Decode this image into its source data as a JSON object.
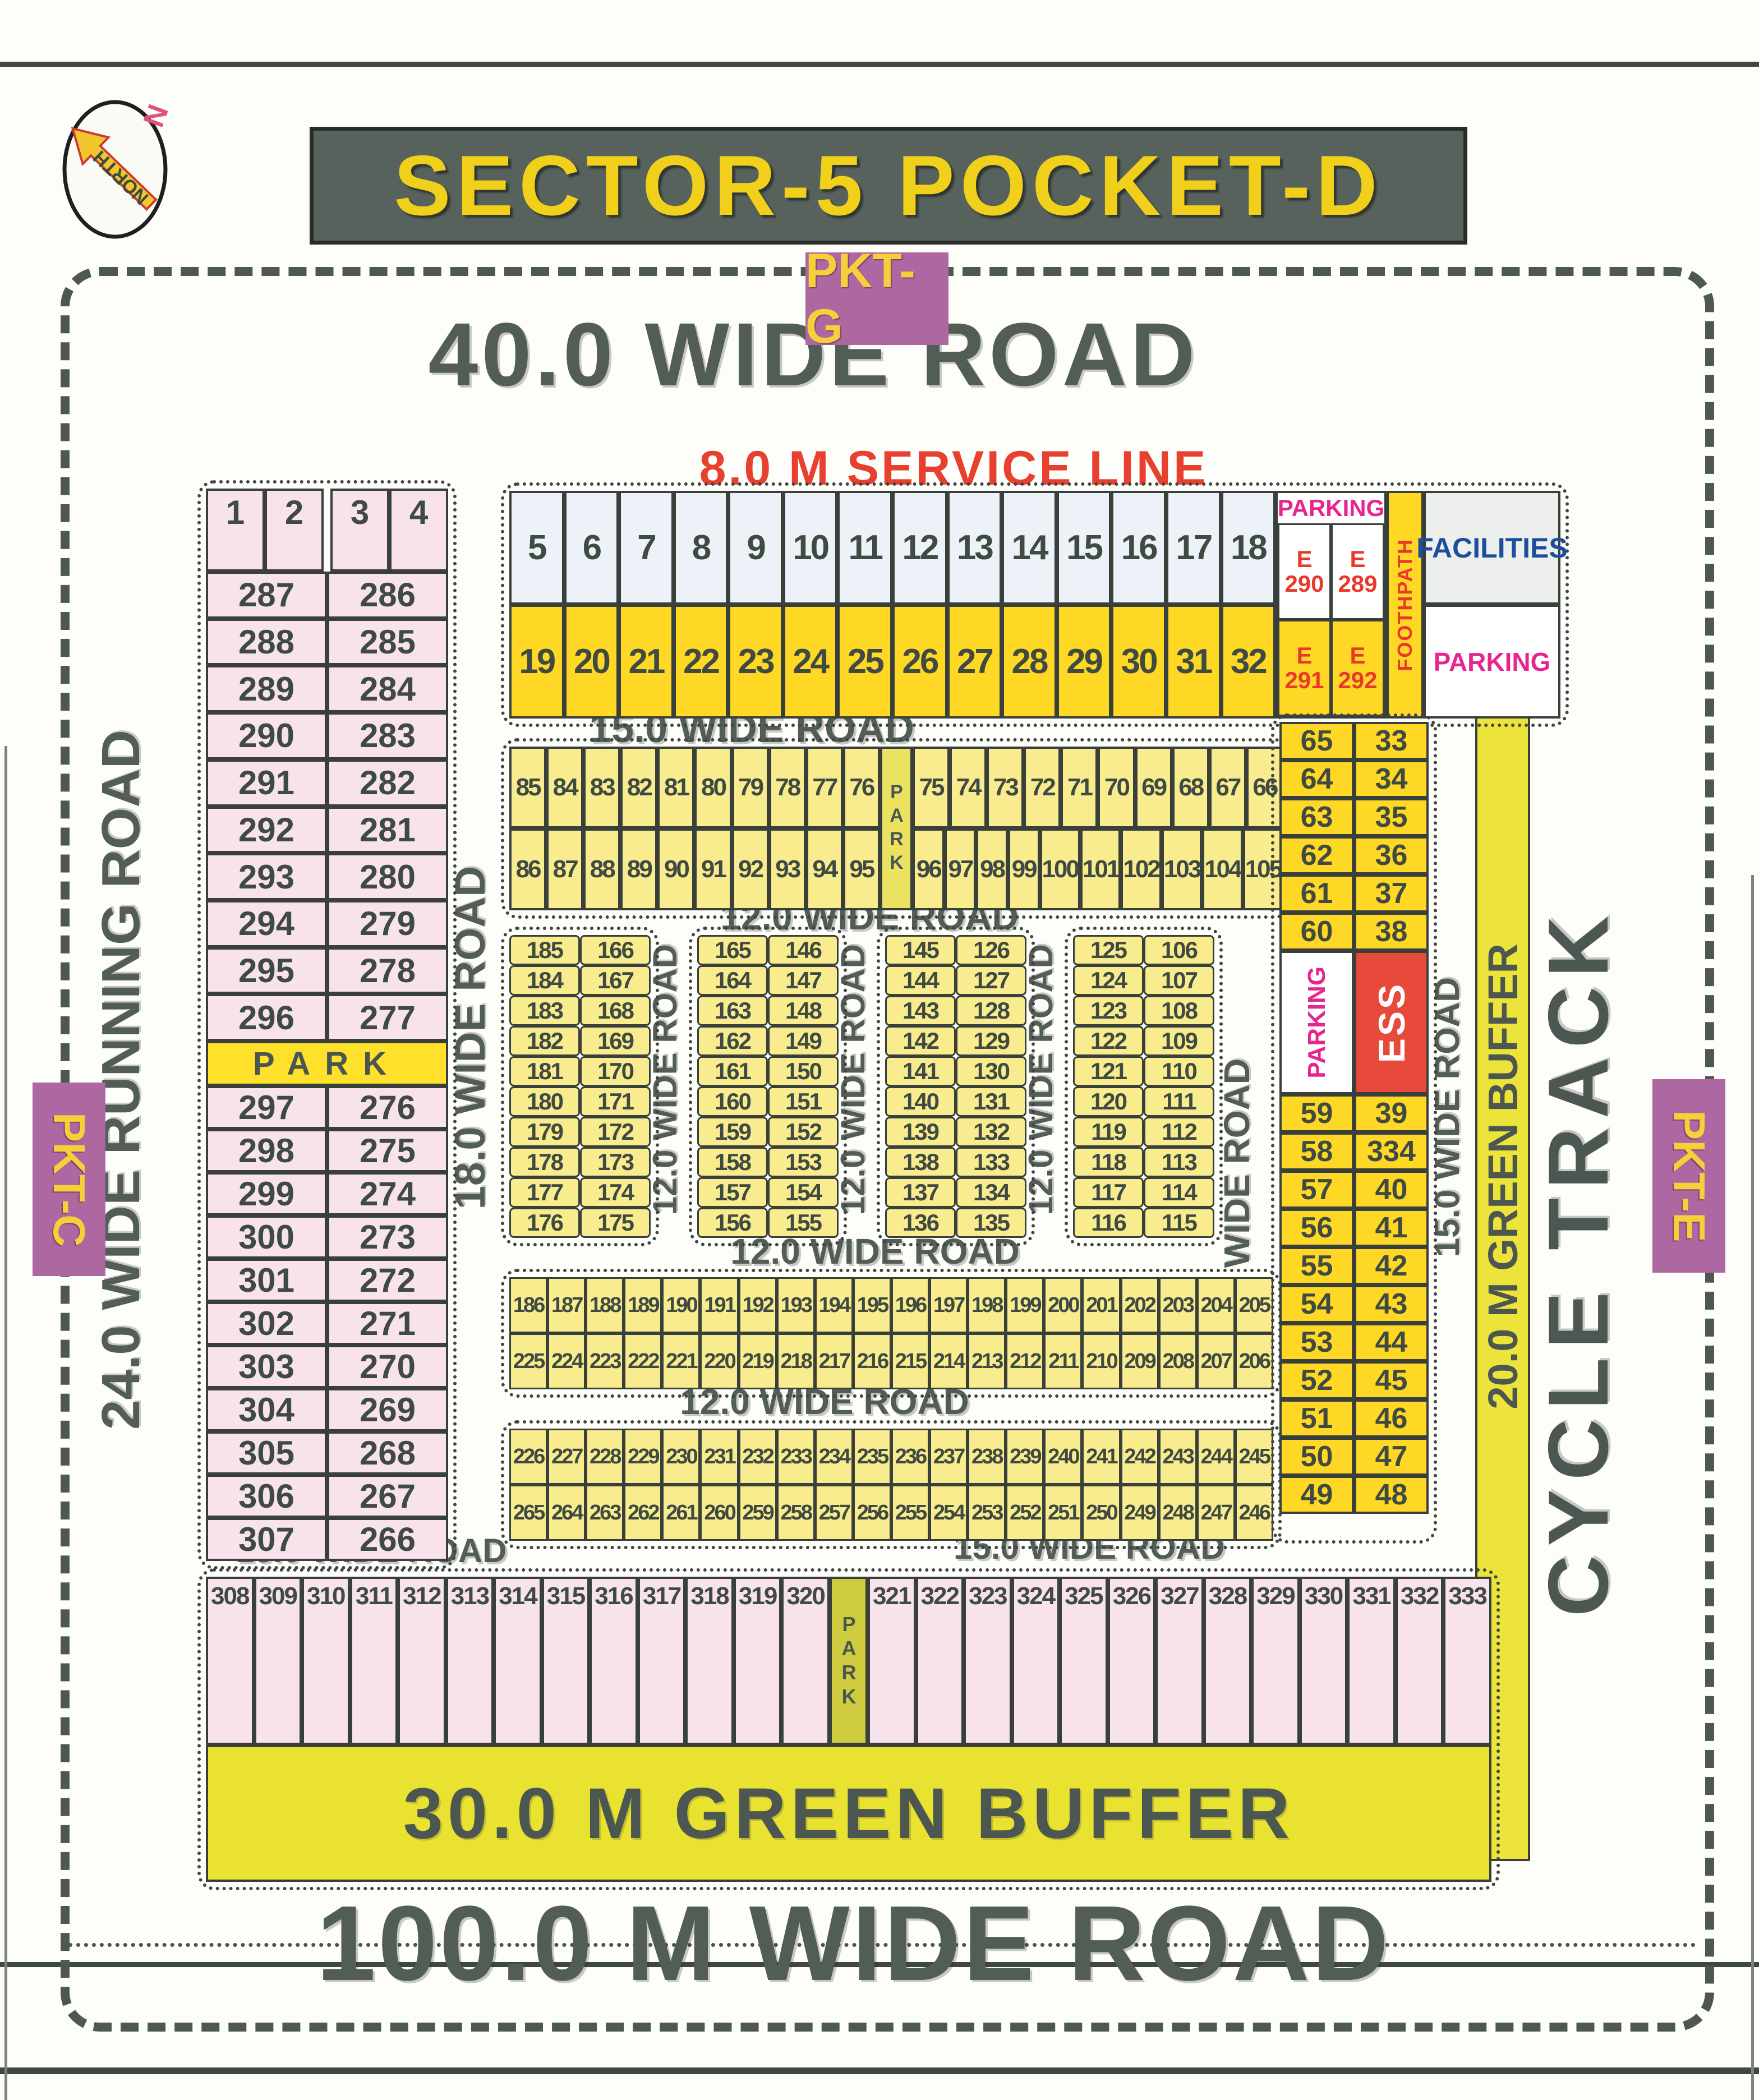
{
  "title": "SECTOR-5 POCKET-D",
  "compass": {
    "north": "NORTH",
    "n": "N"
  },
  "pockets": {
    "g": "PKT-G",
    "c": "PKT-C",
    "e": "PKT-E"
  },
  "roads": {
    "top": "40.0 WIDE ROAD",
    "service_line": "8.0 M SERVICE LINE",
    "r15_top": "15.0 WIDE ROAD",
    "r12_a": "12.0 WIDE ROAD",
    "r12_b": "12.0 WIDE ROAD",
    "r12_c": "12.0 WIDE ROAD",
    "r12_v1": "12.0 WIDE ROAD",
    "r12_v2": "12.0 WIDE ROAD",
    "r12_v3": "12.0 WIDE ROAD",
    "r15_v_inner": "15.0 WIDE ROAD",
    "r15_v_outer": "15.0 WIDE ROAD",
    "r15_bottom_left": "15.0 WIDE ROAD",
    "r15_bottom_right": "15.0 WIDE ROAD",
    "r18_v": "18.0 WIDE ROAD",
    "r24_v": "24.0 WIDE RUNNING ROAD",
    "r100": "100.0 M WIDE ROAD"
  },
  "buffers": {
    "green30": "30.0 M GREEN BUFFER",
    "green20_v": "20.0 M GREEN BUFFER",
    "cycle_track": "CYCLE TRACK"
  },
  "labels": {
    "park": "PARK",
    "parking": "PARKING",
    "foothpath": "FOOTHPATH",
    "facilities": "FACILITIES",
    "ess": "ESS"
  },
  "left_column": {
    "header": [
      "1",
      "2",
      "3",
      "4"
    ],
    "rows_top": [
      [
        "287",
        "286"
      ],
      [
        "288",
        "285"
      ],
      [
        "289",
        "284"
      ],
      [
        "290",
        "283"
      ],
      [
        "291",
        "282"
      ],
      [
        "292",
        "281"
      ],
      [
        "293",
        "280"
      ],
      [
        "294",
        "279"
      ],
      [
        "295",
        "278"
      ],
      [
        "296",
        "277"
      ]
    ],
    "park": "PARK",
    "rows_bottom": [
      [
        "297",
        "276"
      ],
      [
        "298",
        "275"
      ],
      [
        "299",
        "274"
      ],
      [
        "300",
        "273"
      ],
      [
        "301",
        "272"
      ],
      [
        "302",
        "271"
      ],
      [
        "303",
        "270"
      ],
      [
        "304",
        "269"
      ],
      [
        "305",
        "268"
      ],
      [
        "306",
        "267"
      ],
      [
        "307",
        "266"
      ]
    ]
  },
  "service_strip": {
    "row1": [
      "5",
      "6",
      "7",
      "8",
      "9",
      "10",
      "11",
      "12",
      "13",
      "14",
      "15",
      "16",
      "17",
      "18"
    ],
    "row2": [
      "19",
      "20",
      "21",
      "22",
      "23",
      "24",
      "25",
      "26",
      "27",
      "28",
      "29",
      "30",
      "31",
      "32"
    ],
    "parking_label": "PARKING",
    "e_top": [
      [
        "E",
        "290"
      ],
      [
        "E",
        "289"
      ]
    ],
    "e_bottom": [
      [
        "E",
        "291"
      ],
      [
        "E",
        "292"
      ]
    ],
    "foothpath": "FOOTHPATH",
    "facilities": "FACILITIES",
    "parking_bottom": "PARKING"
  },
  "block_a": {
    "row1_left": [
      "85",
      "84",
      "83",
      "82",
      "81",
      "80",
      "79",
      "78",
      "77",
      "76"
    ],
    "row1_right": [
      "75",
      "74",
      "73",
      "72",
      "71",
      "70",
      "69",
      "68",
      "67",
      "66"
    ],
    "row2_left": [
      "86",
      "87",
      "88",
      "89",
      "90",
      "91",
      "92",
      "93",
      "94",
      "95"
    ],
    "row2_right": [
      "96",
      "97",
      "98",
      "99",
      "100",
      "101",
      "102",
      "103",
      "104",
      "105"
    ],
    "park": "PARK"
  },
  "paired_blocks": [
    {
      "rows": [
        [
          "185",
          "166"
        ],
        [
          "184",
          "167"
        ],
        [
          "183",
          "168"
        ],
        [
          "182",
          "169"
        ],
        [
          "181",
          "170"
        ],
        [
          "180",
          "171"
        ],
        [
          "179",
          "172"
        ],
        [
          "178",
          "173"
        ],
        [
          "177",
          "174"
        ],
        [
          "176",
          "175"
        ]
      ]
    },
    {
      "rows": [
        [
          "165",
          "146"
        ],
        [
          "164",
          "147"
        ],
        [
          "163",
          "148"
        ],
        [
          "162",
          "149"
        ],
        [
          "161",
          "150"
        ],
        [
          "160",
          "151"
        ],
        [
          "159",
          "152"
        ],
        [
          "158",
          "153"
        ],
        [
          "157",
          "154"
        ],
        [
          "156",
          "155"
        ]
      ]
    },
    {
      "rows": [
        [
          "145",
          "126"
        ],
        [
          "144",
          "127"
        ],
        [
          "143",
          "128"
        ],
        [
          "142",
          "129"
        ],
        [
          "141",
          "130"
        ],
        [
          "140",
          "131"
        ],
        [
          "139",
          "132"
        ],
        [
          "138",
          "133"
        ],
        [
          "137",
          "134"
        ],
        [
          "136",
          "135"
        ]
      ]
    },
    {
      "rows": [
        [
          "125",
          "106"
        ],
        [
          "124",
          "107"
        ],
        [
          "123",
          "108"
        ],
        [
          "122",
          "109"
        ],
        [
          "121",
          "110"
        ],
        [
          "120",
          "111"
        ],
        [
          "119",
          "112"
        ],
        [
          "118",
          "113"
        ],
        [
          "117",
          "114"
        ],
        [
          "116",
          "115"
        ]
      ]
    }
  ],
  "block_b": {
    "row1": [
      "186",
      "187",
      "188",
      "189",
      "190",
      "191",
      "192",
      "193",
      "194",
      "195",
      "196",
      "197",
      "198",
      "199",
      "200",
      "201",
      "202",
      "203",
      "204",
      "205"
    ],
    "row2": [
      "225",
      "224",
      "223",
      "222",
      "221",
      "220",
      "219",
      "218",
      "217",
      "216",
      "215",
      "214",
      "213",
      "212",
      "211",
      "210",
      "209",
      "208",
      "207",
      "206"
    ]
  },
  "block_c": {
    "row1": [
      "226",
      "227",
      "228",
      "229",
      "230",
      "231",
      "232",
      "233",
      "234",
      "235",
      "236",
      "237",
      "238",
      "239",
      "240",
      "241",
      "242",
      "243",
      "244",
      "245"
    ],
    "row2": [
      "265",
      "264",
      "263",
      "262",
      "261",
      "260",
      "259",
      "258",
      "257",
      "256",
      "255",
      "254",
      "253",
      "252",
      "251",
      "250",
      "249",
      "248",
      "247",
      "246"
    ]
  },
  "right_column": {
    "rows_top": [
      [
        "65",
        "33"
      ],
      [
        "64",
        "34"
      ],
      [
        "63",
        "35"
      ],
      [
        "62",
        "36"
      ],
      [
        "61",
        "37"
      ],
      [
        "60",
        "38"
      ]
    ],
    "parking": "PARKING",
    "ess": "ESS",
    "rows_bottom": [
      [
        "59",
        "39"
      ],
      [
        "58",
        "334"
      ],
      [
        "57",
        "40"
      ],
      [
        "56",
        "41"
      ],
      [
        "55",
        "42"
      ],
      [
        "54",
        "43"
      ],
      [
        "53",
        "44"
      ],
      [
        "52",
        "45"
      ],
      [
        "51",
        "46"
      ],
      [
        "50",
        "47"
      ],
      [
        "49",
        "48"
      ]
    ]
  },
  "bottom_row": {
    "left": [
      "308",
      "309",
      "310",
      "311",
      "312",
      "313",
      "314",
      "315",
      "316",
      "317",
      "318",
      "319",
      "320"
    ],
    "park": "PARK",
    "right": [
      "321",
      "322",
      "323",
      "324",
      "325",
      "326",
      "327",
      "328",
      "329",
      "330",
      "331",
      "332",
      "333"
    ]
  }
}
